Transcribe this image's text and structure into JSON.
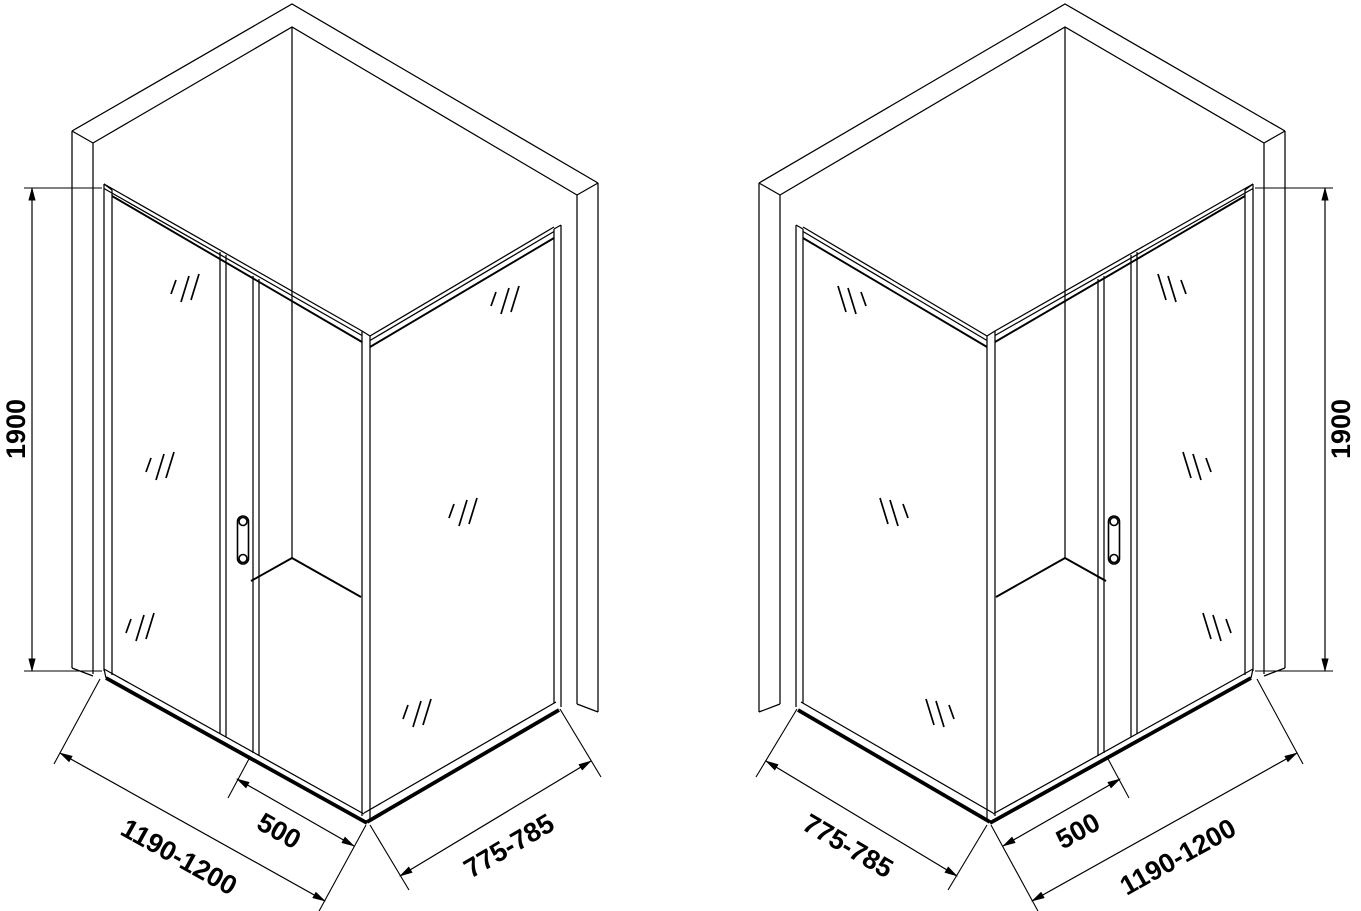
{
  "page": {
    "background": "#ffffff",
    "line_color": "#000000",
    "title": "Corner shower enclosure with sliding door - dimensioned isometric technical drawing, left and right handed versions"
  },
  "drawing": {
    "views": [
      {
        "id": "left-version",
        "labels": {
          "height": "1900",
          "front_width": "1190-1200",
          "door_width": "500",
          "side_depth": "775-785"
        }
      },
      {
        "id": "right-version",
        "labels": {
          "height": "1900",
          "front_width": "1190-1200",
          "door_width": "500",
          "side_depth": "775-785"
        }
      }
    ]
  }
}
